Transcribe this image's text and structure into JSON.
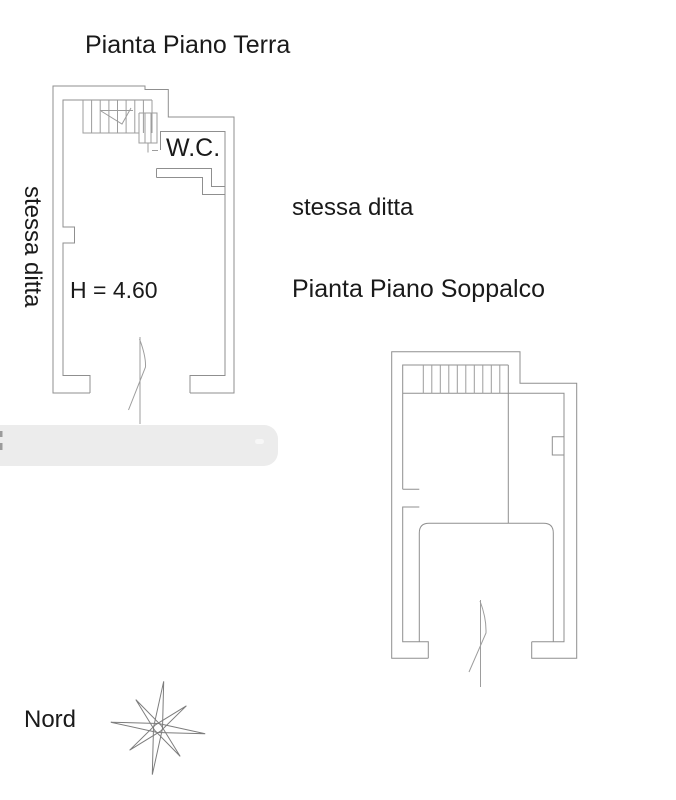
{
  "page": {
    "background_color": "#ffffff",
    "line_color": "#8f8f8f",
    "text_color": "#1a1a1a",
    "redaction_color": "#ececec"
  },
  "ground_floor": {
    "title": "Pianta Piano Terra",
    "side_label_vertical": "stessa ditta",
    "room_label": "W.C.",
    "height_annotation": "H = 4.60"
  },
  "mezzanine": {
    "neighbor_label": "stessa ditta",
    "title": "Pianta Piano Soppalco"
  },
  "compass": {
    "label": "Nord"
  }
}
